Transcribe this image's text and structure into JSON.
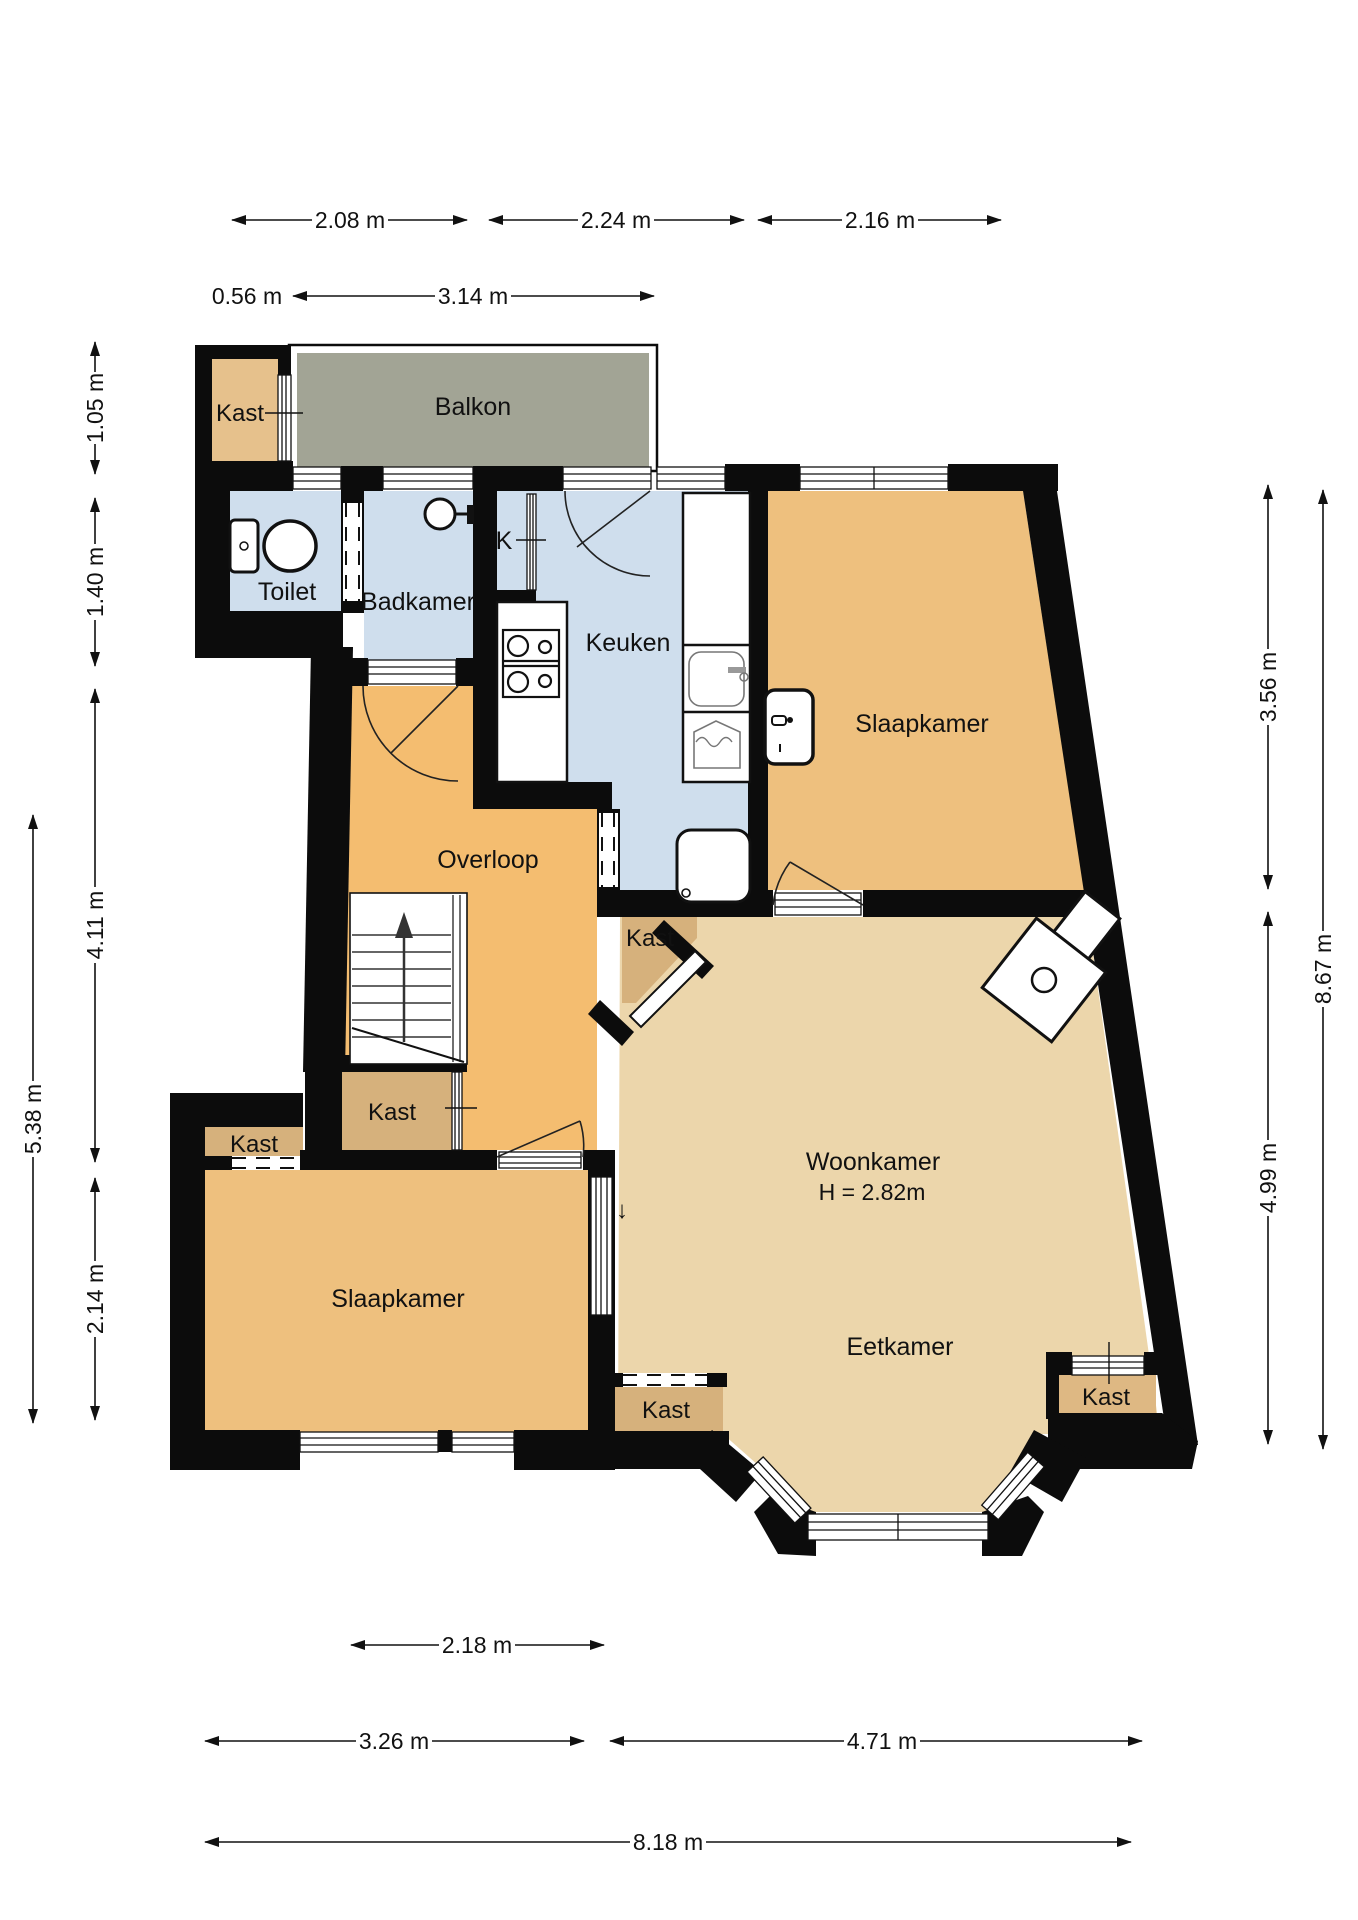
{
  "plan": {
    "colors": {
      "wall": "#0c0c0c",
      "wet_room_floor": "#cfdeed",
      "balcony_floor": "#a2a495",
      "hall_floor": "#f4bd70",
      "bedroom_floor": "#eec07e",
      "living_floor": "#ecd6ab",
      "closet_dark": "#d6b17c",
      "closet_light": "#e6c18c"
    },
    "rooms": {
      "kast_balkon": {
        "label": "Kast"
      },
      "balkon": {
        "label": "Balkon"
      },
      "toilet": {
        "label": "Toilet"
      },
      "badkamer": {
        "label": "Badkamer"
      },
      "k": {
        "label": "K"
      },
      "keuken": {
        "label": "Keuken"
      },
      "slaapkamer_rechts": {
        "label": "Slaapkamer"
      },
      "overloop": {
        "label": "Overloop"
      },
      "kast_woonkamer": {
        "label": "Kast"
      },
      "woonkamer": {
        "label": "Woonkamer",
        "height_label": "H = 2.82m"
      },
      "kast_overloop": {
        "label": "Kast"
      },
      "kast_slaapkamer": {
        "label": "Kast"
      },
      "slaapkamer_links": {
        "label": "Slaapkamer"
      },
      "eetkamer": {
        "label": "Eetkamer"
      },
      "kast_erker_links": {
        "label": "Kast"
      },
      "kast_erker_rechts": {
        "label": "Kast"
      }
    },
    "dims": {
      "d208": "2.08 m",
      "d224": "2.24 m",
      "d216": "2.16 m",
      "d056": "0.56 m",
      "d314": "3.14 m",
      "d105": "1.05 m",
      "d140": "1.40 m",
      "d411": "4.11 m",
      "d538": "5.38 m",
      "d214": "2.14 m",
      "d356": "3.56 m",
      "d867": "8.67 m",
      "d499": "4.99 m",
      "d218": "2.18 m",
      "d326": "3.26 m",
      "d471": "4.71 m",
      "d818": "8.18 m"
    },
    "icons": {
      "toilet": "toilet-icon",
      "shower": "shower-head-icon",
      "stove": "gas-stove-icon",
      "sink": "kitchen-sink-icon",
      "laundry": "basin-icon",
      "fridge": "fridge-icon",
      "wash_basin": "wash-basin-icon",
      "heater": "stove-heater-icon",
      "stairs": "staircase-icon",
      "stairs_up_arrow": "▲",
      "level_down_arrow": "↓"
    }
  }
}
